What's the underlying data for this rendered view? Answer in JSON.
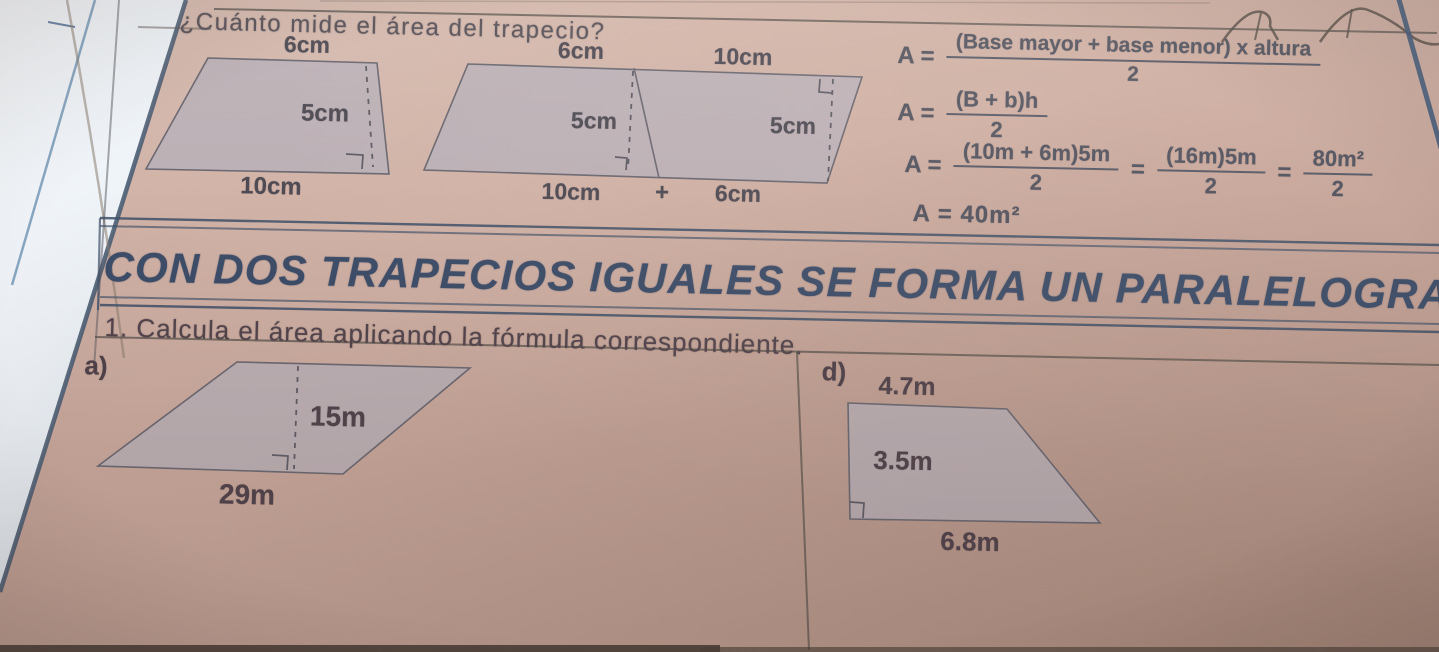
{
  "page": {
    "title": "¿Cuánto mide el área del trapecio?",
    "banner": "CON DOS TRAPECIOS IGUALES SE FORMA UN PARALELOGRAMO",
    "instruction": "1. Calcula el área aplicando la fórmula correspondiente."
  },
  "example": {
    "trapezoid_single": {
      "top": "6cm",
      "height": "5cm",
      "bottom": "10cm"
    },
    "trapezoid_pair": {
      "left_top": "6cm",
      "right_top": "10cm",
      "left_height": "5cm",
      "right_height": "5cm",
      "bottom_left": "10cm",
      "plus": "+",
      "bottom_right": "6cm"
    }
  },
  "formulas": {
    "line1": {
      "lhs": "A =",
      "numerator": "(Base mayor + base menor) x altura",
      "denominator": "2"
    },
    "line2": {
      "lhs": "A =",
      "numerator": "(B + b)h",
      "denominator": "2"
    },
    "line3": {
      "lhs": "A =",
      "f1num": "(10m + 6m)5m",
      "f1den": "2",
      "eq1": "=",
      "f2num": "(16m)5m",
      "f2den": "2",
      "eq2": "=",
      "f3num": "80m²",
      "f3den": "2"
    },
    "line4": "A =  40m²"
  },
  "exercises": {
    "a": {
      "label": "a)",
      "height": "15m",
      "base": "29m"
    },
    "d": {
      "label": "d)",
      "top": "4.7m",
      "side": "3.5m",
      "base": "6.8m"
    }
  },
  "colors": {
    "page_tan": "#cbab9e",
    "figure_fill": "#b6b0b9",
    "figure_stroke": "#6b6871",
    "banner_blue": "#3d4d68",
    "ink_gray": "#50525e",
    "rule_line": "#59544e"
  }
}
